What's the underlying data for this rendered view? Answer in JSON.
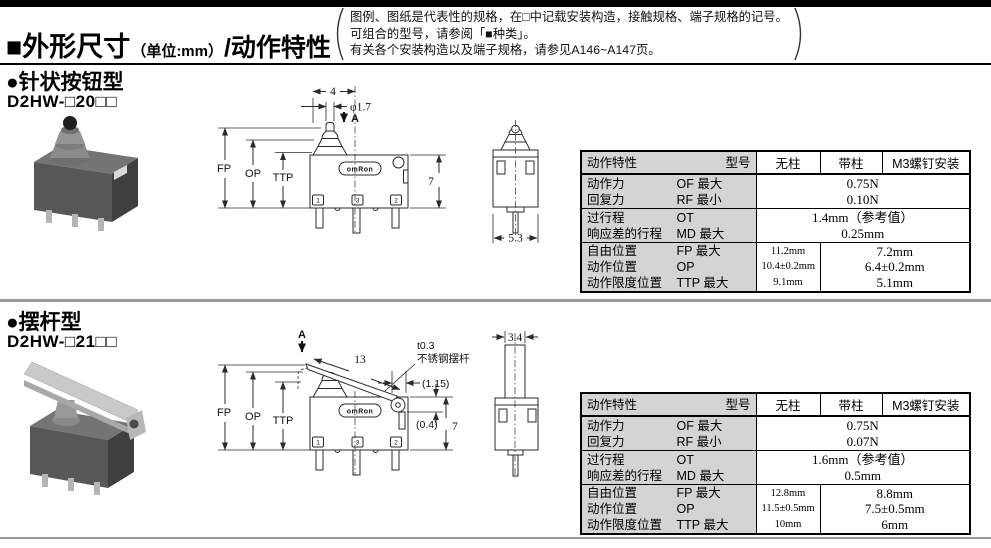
{
  "page": {
    "title": "■外形尺寸",
    "title_unit": "（单位:mm）",
    "title_suffix": "/动作特性",
    "note_line1": "图例、图纸是代表性的规格，在□中记载安装构造，接触规格、端子规格的记号。",
    "note_line2": "可组合的型号，请参阅「■种类」。",
    "note_line3": "有关各个安装构造以及端子规格，请参见A146~A147页。"
  },
  "colors": {
    "table_label_bg": "#d4d4d4",
    "divider": "#9a9a9a",
    "topbar": "#000000"
  },
  "section1": {
    "heading": "●针状按钮型",
    "model": "D2HW-□20□□",
    "diagram": {
      "dim_4": "4",
      "dim_dia": "φ1.7",
      "label_a": "A",
      "fp": "FP",
      "op": "OP",
      "ttp": "TTP",
      "logo": "omRon",
      "term_1": "1",
      "term_3": "3",
      "term_2": "2",
      "dim_7": "7",
      "dim_53": "5.3"
    },
    "table": {
      "header_left": "动作特性",
      "header_model": "型号",
      "col_nopost": "无柱",
      "col_post": "带柱",
      "col_m3": "M3螺钉安装",
      "g1": {
        "l1": "动作力",
        "c1": "OF 最大",
        "l2": "回复力",
        "c2": "RF 最小",
        "v1": "0.75N",
        "v2": "0.10N"
      },
      "g2": {
        "l1": "过行程",
        "c1": "OT",
        "l2": "响应差的行程",
        "c2": "MD 最大",
        "v1": "1.4mm（参考值）",
        "v2": "0.25mm"
      },
      "g3": {
        "l1": "自由位置",
        "c1": "FP 最大",
        "l2": "动作位置",
        "c2": "OP",
        "l3": "动作限度位置",
        "c3": "TTP 最大",
        "np1": "11.2mm",
        "np2": "10.4±0.2mm",
        "np3": "9.1mm",
        "m1": "7.2mm",
        "m2": "6.4±0.2mm",
        "m3": "5.1mm"
      }
    }
  },
  "section2": {
    "heading": "●摆杆型",
    "model": "D2HW-□21□□",
    "diagram": {
      "label_a": "A",
      "dim_13": "13",
      "lever_t": "t0.3",
      "lever_mat": "不锈钢摆杆",
      "dim_115": "(1.15)",
      "dim_04": "(0.4)",
      "fp": "FP",
      "op": "OP",
      "ttp": "TTP",
      "logo": "omRon",
      "term_1": "1",
      "term_3": "3",
      "term_2": "2",
      "dim_7": "7",
      "dim_34": "3.4"
    },
    "table": {
      "header_left": "动作特性",
      "header_model": "型号",
      "col_nopost": "无柱",
      "col_post": "带柱",
      "col_m3": "M3螺钉安装",
      "g1": {
        "l1": "动作力",
        "c1": "OF 最大",
        "l2": "回复力",
        "c2": "RF 最小",
        "v1": "0.75N",
        "v2": "0.07N"
      },
      "g2": {
        "l1": "过行程",
        "c1": "OT",
        "l2": "响应差的行程",
        "c2": "MD 最大",
        "v1": "1.6mm（参考值）",
        "v2": "0.5mm"
      },
      "g3": {
        "l1": "自由位置",
        "c1": "FP 最大",
        "l2": "动作位置",
        "c2": "OP",
        "l3": "动作限度位置",
        "c3": "TTP 最大",
        "np1": "12.8mm",
        "np2": "11.5±0.5mm",
        "np3": "10mm",
        "m1": "8.8mm",
        "m2": "7.5±0.5mm",
        "m3": "6mm"
      }
    }
  }
}
